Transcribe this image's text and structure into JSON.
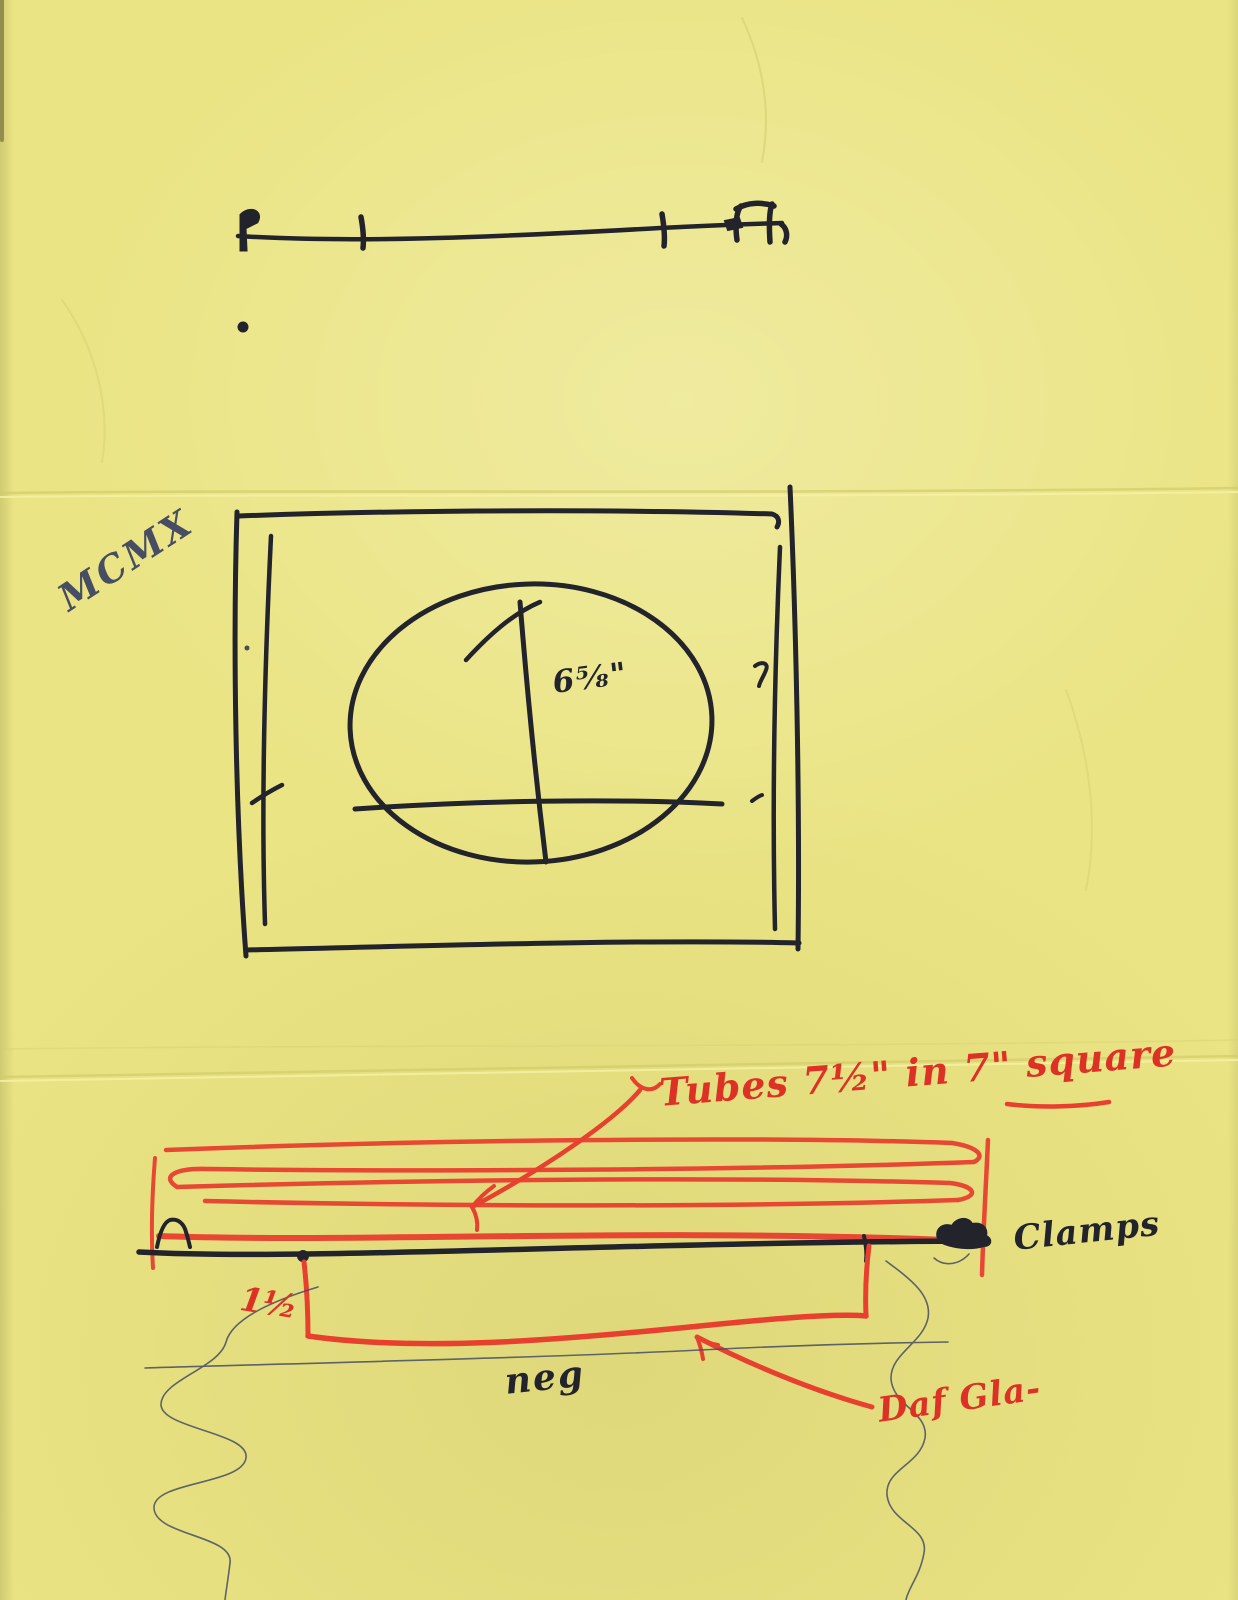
{
  "document": {
    "kind": "hand-drawn apparatus sketch on folded yellow paper",
    "panels": [
      "top: bar with end clamps",
      "middle: plate with oval opening",
      "bottom: lamp tube coil over clamped negative and glass"
    ]
  },
  "labels": {
    "roman_numeral": "MCMX",
    "oval_dimension": "6⅝\"",
    "tubes": "Tubes 7½\" in 7\" square",
    "clamps": "Clamps",
    "gap": "1½",
    "negative": "neg",
    "glass": "Daf Gla-"
  },
  "colors": {
    "paper": "#eae484",
    "ink": "#23232c",
    "marker_red": "#e8402f",
    "red_text": "#dc3124",
    "pencil": "#474d63",
    "crease_shadow": "#d2cc69",
    "crease_highlight": "#f6f1a4"
  }
}
